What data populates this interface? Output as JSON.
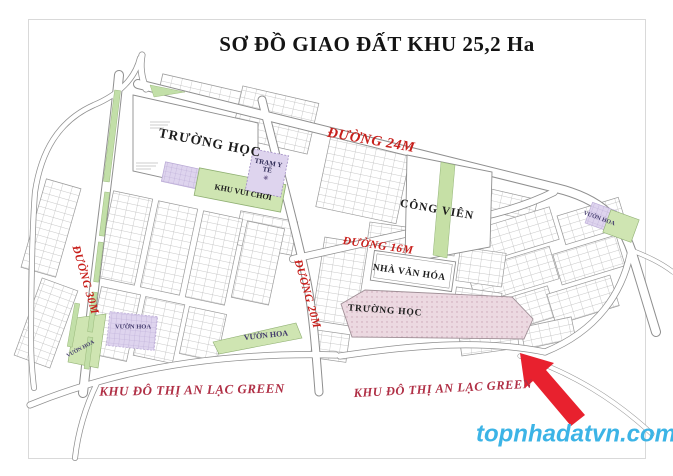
{
  "title": "SƠ ĐỒ GIAO ĐẤT KHU 25,2 Ha",
  "watermark": "topnhadatvn.com",
  "roads": {
    "d24": "ĐƯỜNG 24M",
    "d16": "ĐƯỜNG 16M",
    "d30": "ĐƯỜNG 30M",
    "d20": "ĐƯỜNG 20M"
  },
  "areas": {
    "school_top": "TRƯỜNG HỌC",
    "school_pink": "TRƯỜNG HỌC",
    "medical": "TRẠM Y TẾ",
    "medical_marker": "✳",
    "playground": "KHU VUI CHƠI",
    "park": "CÔNG VIÊN",
    "culture_house": "NHÀ VĂN HÓA",
    "flower_tr": "VƯỜN HOA",
    "flower_bl": "VƯỜN HOA",
    "flower_bm": "VƯỜN HOA",
    "flower_small": "VƯỜN HOA"
  },
  "districts": {
    "left": "KHU ĐÔ THỊ AN LẠC GREEN",
    "right": "KHU ĐÔ THỊ AN LẠC GREEN"
  },
  "colors": {
    "road_label": "#c8201c",
    "district_label": "#b03046",
    "watermark": "#3cb4e6",
    "arrow": "#e8212e",
    "green_area": "#cfe5b2",
    "purple_area": "#ded4ee",
    "pink_area": "#ecd9e1",
    "map_lines": "#8f8f8f"
  }
}
